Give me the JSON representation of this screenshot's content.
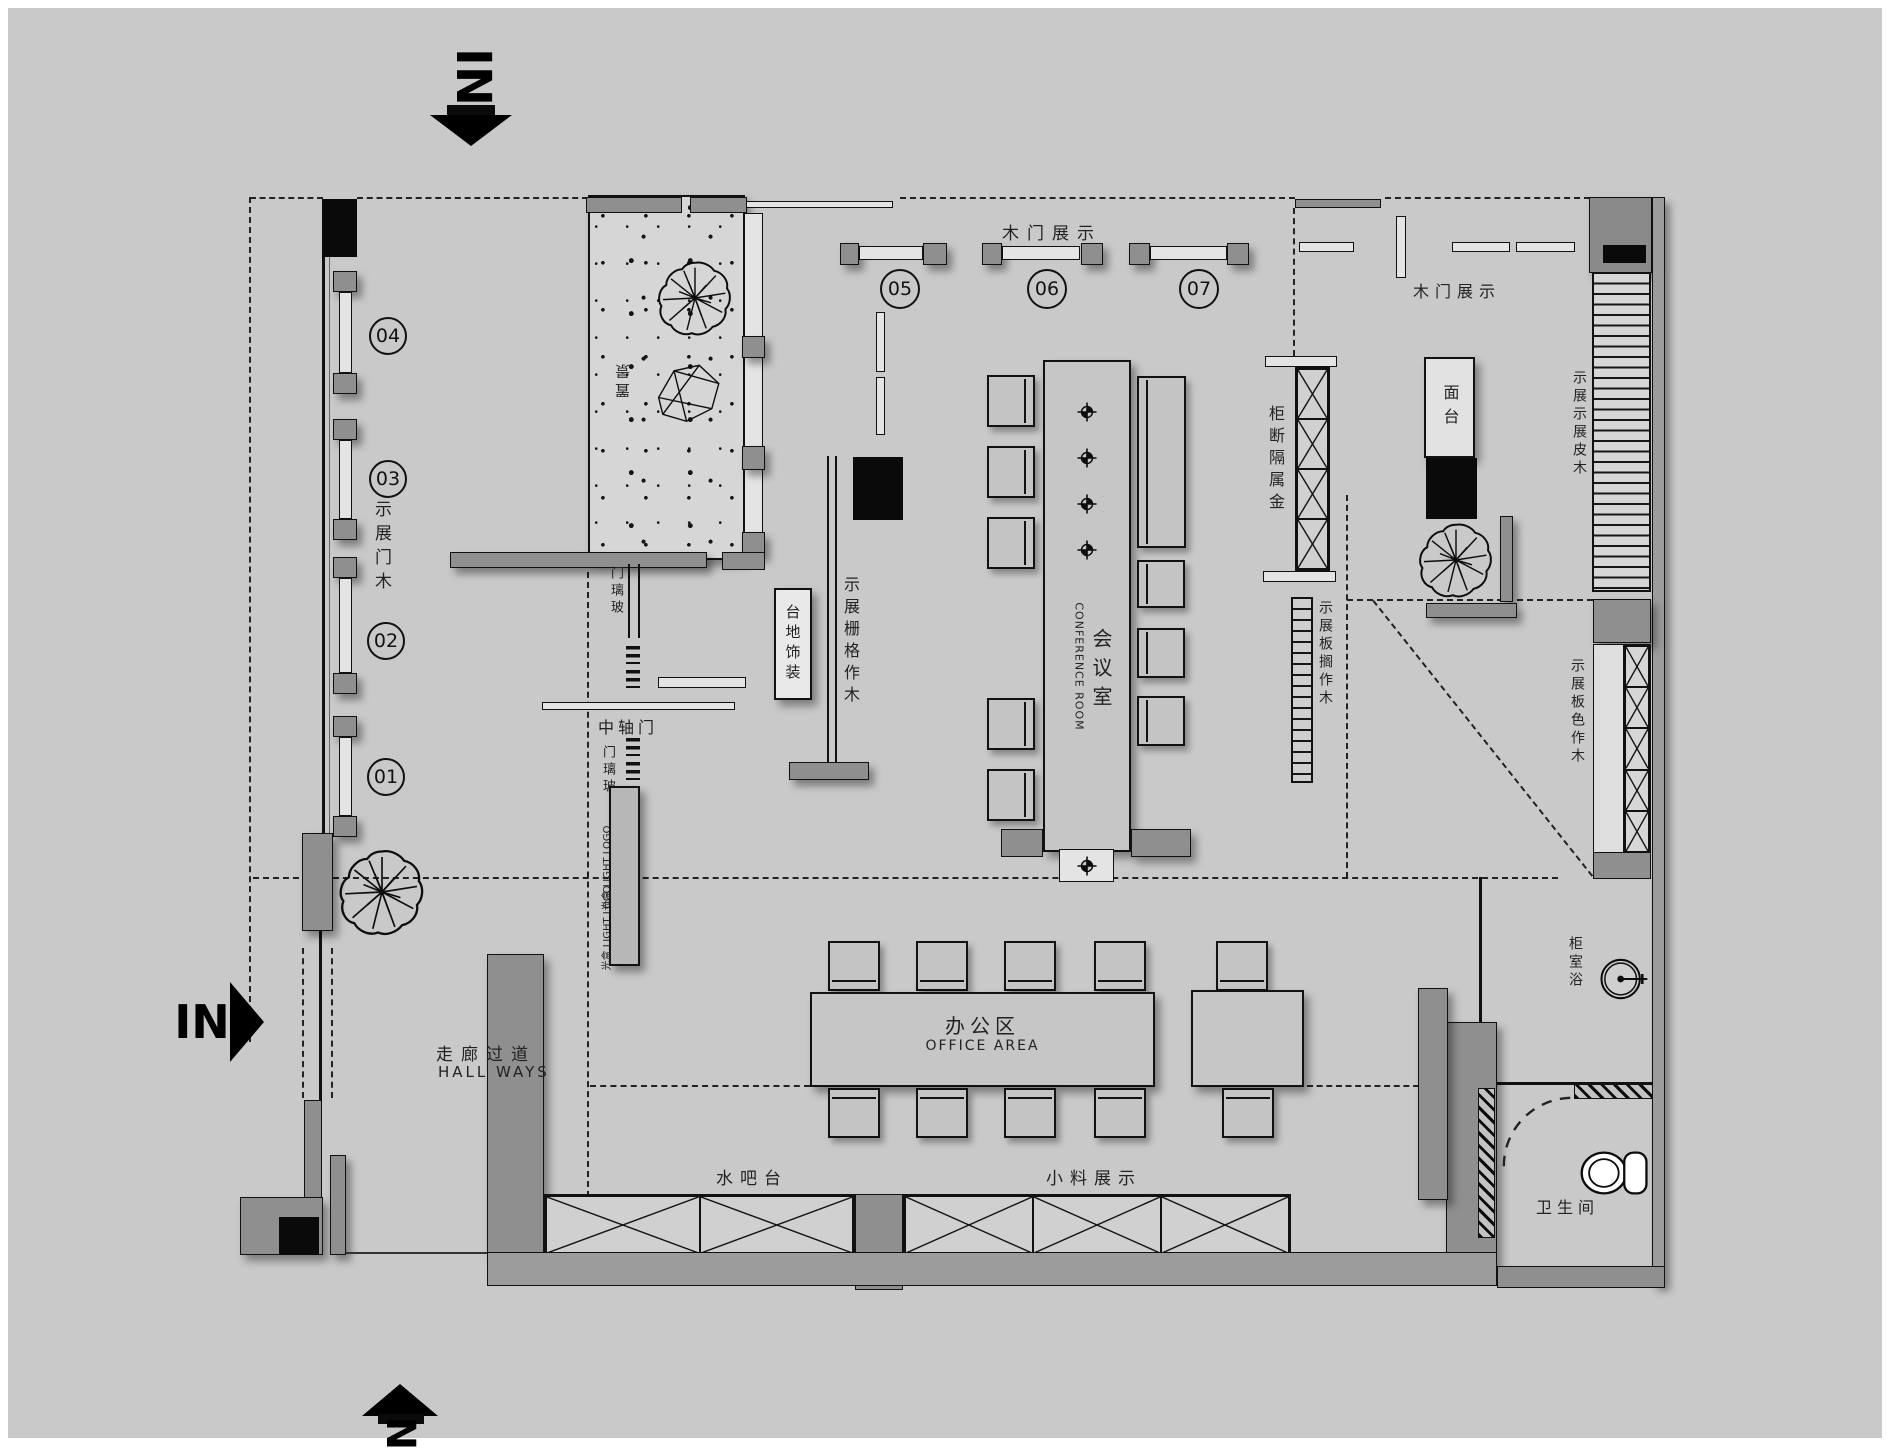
{
  "meta": {
    "bg_color": "#c9c9c9",
    "line_color": "#111111",
    "wall_color": "#8f8f8f",
    "panel_color": "#e4e4e4",
    "black_color": "#0a0a0a"
  },
  "arrows": {
    "top": "IN",
    "left": "IN",
    "bottom": "IN"
  },
  "circles": {
    "c01": "01",
    "c02": "02",
    "c03": "03",
    "c04": "04",
    "c05": "05",
    "c06": "06",
    "c07": "07"
  },
  "labels": {
    "wood_door_left": "木门展示",
    "wood_door_top": "木门展示",
    "wood_door_top_right": "木门展示",
    "scenery": "置景",
    "glass_door_upper": "玻璃门",
    "pivot_door": "中轴门",
    "glass_door_lower": "玻璃门",
    "light_logo_1": "光盒 LIGHT LOGO",
    "light_logo_2": "光盒 LIGHT LOGO",
    "decor_platform": "装饰地台",
    "wood_grille": "木作格栅展示",
    "conference_cn": "会议室",
    "conference_en": "CONFERENCE ROOM",
    "metal_cabinet": "金属隔断柜",
    "wood_shelf": "木作搁板展示",
    "countertop": "台面",
    "wood_veneer": "木皮展示展示",
    "wood_color_board": "木作色板展示",
    "office_cn": "办公区",
    "office_en": "OFFICE AREA",
    "hallway_cn": "走廊过道",
    "hallway_en": "HALL WAYS",
    "water_bar": "水吧台",
    "small_material": "小料展示",
    "bath_cabinet": "浴室柜",
    "toilet": "卫生间"
  }
}
